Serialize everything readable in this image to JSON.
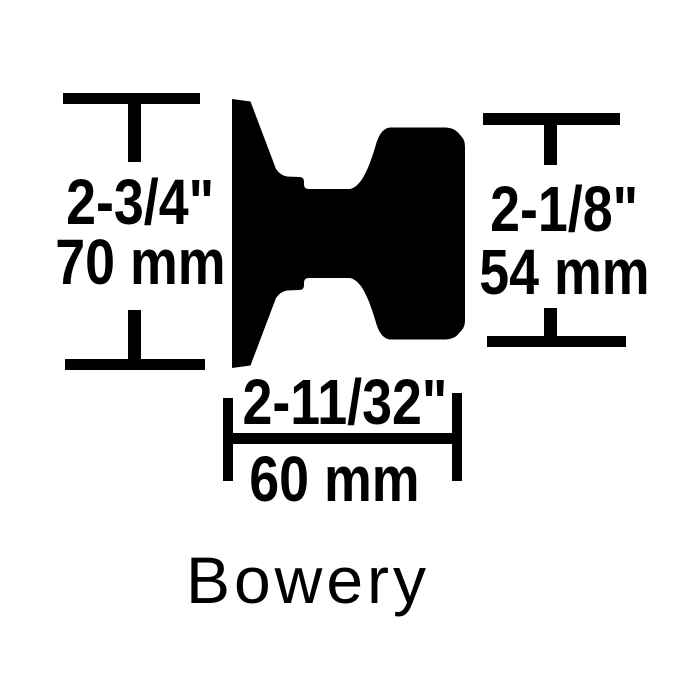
{
  "diagram": {
    "product_name": "Bowery",
    "colors": {
      "ink": "#000000",
      "background": "#ffffff"
    },
    "dimensions": {
      "rose_height": {
        "imperial": "2-3/4\"",
        "metric": "70 mm"
      },
      "knob_height": {
        "imperial": "2-1/8\"",
        "metric": "54 mm"
      },
      "knob_depth": {
        "imperial": "2-11/32\"",
        "metric": "60 mm"
      }
    }
  }
}
